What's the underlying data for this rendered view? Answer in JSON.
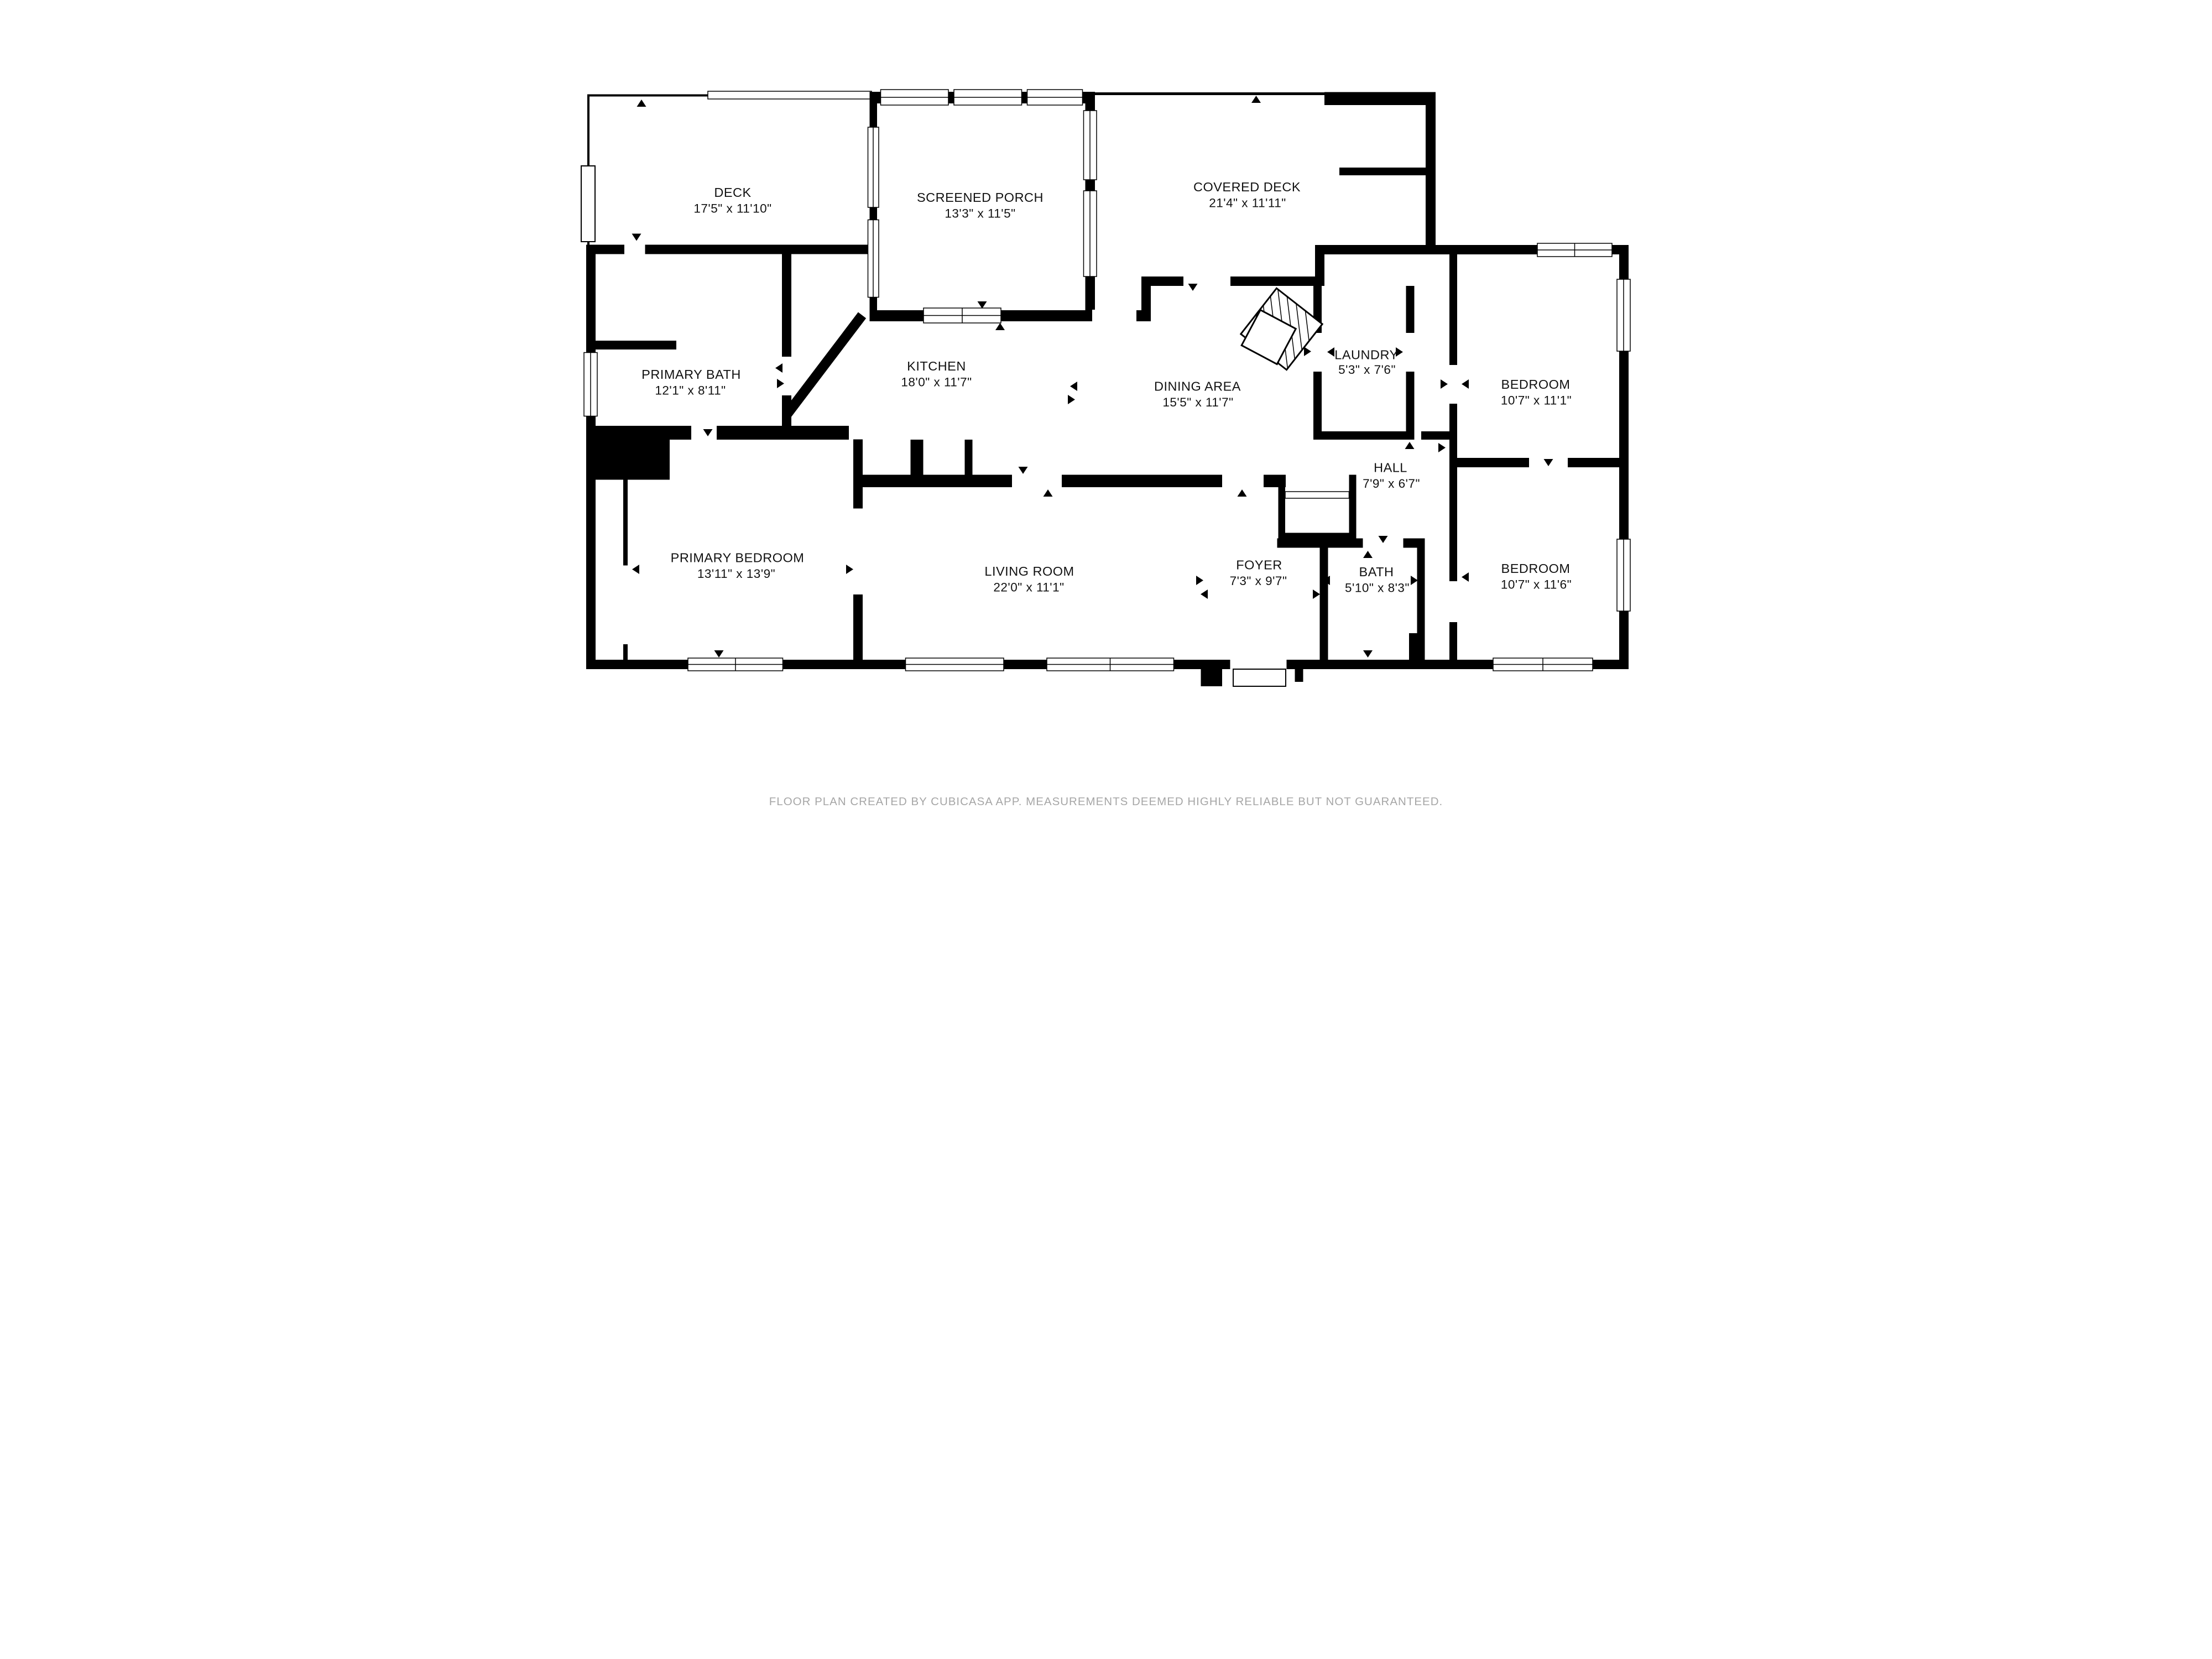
{
  "title": "Floor plan",
  "rooms": [
    {
      "name": "DECK",
      "dims": "17'5\" x 11'10\""
    },
    {
      "name": "SCREENED PORCH",
      "dims": "13'3\" x 11'5\""
    },
    {
      "name": "COVERED DECK",
      "dims": "21'4\" x 11'11\""
    },
    {
      "name": "PRIMARY BATH",
      "dims": "12'1\" x 8'11\""
    },
    {
      "name": "KITCHEN",
      "dims": "18'0\" x 11'7\""
    },
    {
      "name": "DINING AREA",
      "dims": "15'5\" x 11'7\""
    },
    {
      "name": "LAUNDRY",
      "dims": "5'3\" x 7'6\""
    },
    {
      "name": "BEDROOM",
      "dims": "10'7\" x 11'1\""
    },
    {
      "name": "HALL",
      "dims": "7'9\" x 6'7\""
    },
    {
      "name": "PRIMARY BEDROOM",
      "dims": "13'11\" x 13'9\""
    },
    {
      "name": "LIVING ROOM",
      "dims": "22'0\" x 11'1\""
    },
    {
      "name": "FOYER",
      "dims": "7'3\" x 9'7\""
    },
    {
      "name": "BATH",
      "dims": "5'10\" x 8'3\""
    },
    {
      "name": "BEDROOM",
      "dims": "10'7\" x 11'6\""
    }
  ],
  "footer": {
    "text": "FLOOR PLAN CREATED BY CUBICASA APP. MEASUREMENTS DEEMED HIGHLY RELIABLE BUT NOT GUARANTEED."
  },
  "colors": {
    "wall": "#000000",
    "background": "#ffffff",
    "footer_text": "#a6a6a6",
    "label_text": "#111111"
  }
}
